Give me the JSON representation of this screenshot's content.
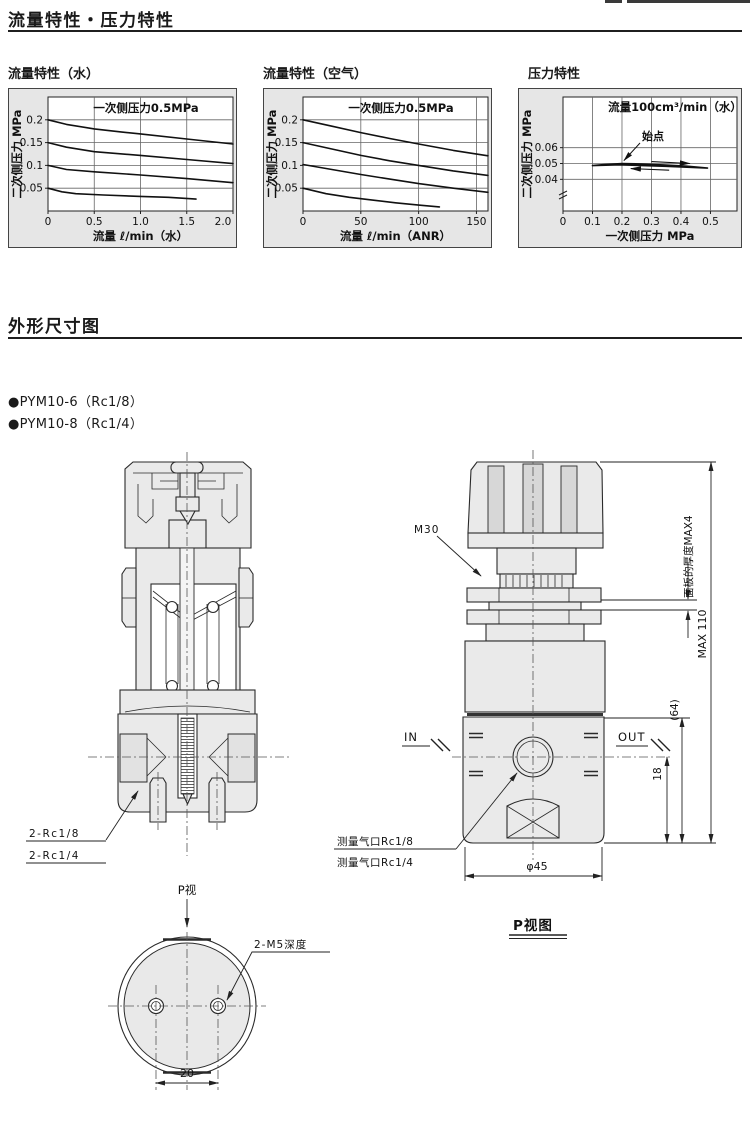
{
  "page": {
    "header1": "流量特性・压力特性",
    "header2": "外形尺寸图",
    "bullets": [
      "●PYM10-6（Rc1/8）",
      "●PYM10-8（Rc1/4）"
    ]
  },
  "colors": {
    "line": "#111111",
    "chart_panel_bg": "#e6e6e6",
    "plot_bg": "#ffffff",
    "drawing_fill": "#eaeaea"
  },
  "chart_data": [
    {
      "type": "line",
      "title": "流量特性（水）",
      "annotation": "一次侧压力0.5MPa",
      "xlabel": "流量 ℓ/min（水）",
      "ylabel": "二次侧压力 MPa",
      "xlim": [
        0,
        2.0
      ],
      "ylim": [
        0,
        0.25
      ],
      "xticks": [
        0,
        0.5,
        1.0,
        1.5,
        2.0
      ],
      "xtick_labels": [
        "0",
        "0.5",
        "1.0",
        "1.5",
        "2.0"
      ],
      "yticks": [
        0.05,
        0.1,
        0.15,
        0.2
      ],
      "ytick_labels": [
        "0.05",
        "0.1",
        "0.15",
        "0.2"
      ],
      "grid": true,
      "legend": "none",
      "series": [
        {
          "name": "0.2MPa",
          "points": [
            [
              0,
              0.2
            ],
            [
              0.2,
              0.19
            ],
            [
              0.5,
              0.18
            ],
            [
              0.8,
              0.173
            ],
            [
              1.0,
              0.169
            ],
            [
              1.5,
              0.158
            ],
            [
              2.0,
              0.147
            ]
          ]
        },
        {
          "name": "0.15MPa",
          "points": [
            [
              0,
              0.15
            ],
            [
              0.2,
              0.14
            ],
            [
              0.5,
              0.13
            ],
            [
              1.0,
              0.122
            ],
            [
              1.5,
              0.113
            ],
            [
              2.0,
              0.104
            ]
          ]
        },
        {
          "name": "0.1MPa",
          "points": [
            [
              0,
              0.1
            ],
            [
              0.2,
              0.091
            ],
            [
              0.5,
              0.086
            ],
            [
              1.0,
              0.079
            ],
            [
              1.5,
              0.071
            ],
            [
              2.0,
              0.062
            ]
          ]
        },
        {
          "name": "0.05MPa",
          "points": [
            [
              0,
              0.05
            ],
            [
              0.15,
              0.042
            ],
            [
              0.3,
              0.038
            ],
            [
              0.6,
              0.035
            ],
            [
              1.0,
              0.032
            ],
            [
              1.3,
              0.03
            ],
            [
              1.6,
              0.026
            ]
          ]
        }
      ]
    },
    {
      "type": "line",
      "title": "流量特性（空气）",
      "annotation": "一次侧压力0.5MPa",
      "xlabel": "流量 ℓ/min（ANR）",
      "ylabel": "二次侧压力 MPa",
      "xlim": [
        0,
        160
      ],
      "ylim": [
        0,
        0.25
      ],
      "xticks": [
        0,
        50,
        100,
        150
      ],
      "xtick_labels": [
        "0",
        "50",
        "100",
        "150"
      ],
      "yticks": [
        0.05,
        0.1,
        0.15,
        0.2
      ],
      "ytick_labels": [
        "0.05",
        "0.1",
        "0.15",
        "0.2"
      ],
      "grid": true,
      "legend": "none",
      "series": [
        {
          "name": "0.2MPa",
          "points": [
            [
              0,
              0.2
            ],
            [
              25,
              0.186
            ],
            [
              50,
              0.172
            ],
            [
              75,
              0.159
            ],
            [
              100,
              0.147
            ],
            [
              130,
              0.133
            ],
            [
              160,
              0.121
            ]
          ]
        },
        {
          "name": "0.15MPa",
          "points": [
            [
              0,
              0.15
            ],
            [
              25,
              0.136
            ],
            [
              50,
              0.122
            ],
            [
              75,
              0.11
            ],
            [
              100,
              0.1
            ],
            [
              130,
              0.088
            ],
            [
              160,
              0.078
            ]
          ]
        },
        {
          "name": "0.1MPa",
          "points": [
            [
              0,
              0.102
            ],
            [
              25,
              0.091
            ],
            [
              50,
              0.08
            ],
            [
              75,
              0.07
            ],
            [
              100,
              0.06
            ],
            [
              130,
              0.05
            ],
            [
              160,
              0.041
            ]
          ]
        },
        {
          "name": "0.05MPa",
          "points": [
            [
              0,
              0.05
            ],
            [
              20,
              0.038
            ],
            [
              40,
              0.03
            ],
            [
              60,
              0.024
            ],
            [
              80,
              0.018
            ],
            [
              100,
              0.013
            ],
            [
              118,
              0.009
            ]
          ]
        }
      ]
    },
    {
      "type": "line",
      "title": "压力特性",
      "annotation": "流量100cm³/min（水）",
      "xlabel": "一次侧压力 MPa",
      "ylabel": "二次侧压力 MPa",
      "xlim": [
        0,
        0.59
      ],
      "ylim": [
        0.02,
        0.092
      ],
      "xticks": [
        0,
        0.1,
        0.2,
        0.3,
        0.4,
        0.5
      ],
      "xtick_labels": [
        "0",
        "0.1",
        "0.2",
        "0.3",
        "0.4",
        "0.5"
      ],
      "yticks": [
        0.04,
        0.05,
        0.06
      ],
      "ytick_labels": [
        "0.04",
        "0.05",
        "0.06"
      ],
      "grid": true,
      "legend": "none",
      "series": [
        {
          "name": "hysteresis-loop",
          "points": [
            [
              0.1,
              0.0487
            ],
            [
              0.14,
              0.0494
            ],
            [
              0.2,
              0.05
            ],
            [
              0.27,
              0.0497
            ],
            [
              0.34,
              0.0491
            ],
            [
              0.42,
              0.0483
            ],
            [
              0.49,
              0.0471
            ],
            [
              0.43,
              0.0476
            ],
            [
              0.35,
              0.0482
            ],
            [
              0.27,
              0.0487
            ],
            [
              0.19,
              0.0492
            ],
            [
              0.1,
              0.0487
            ]
          ]
        }
      ],
      "annotations": {
        "start_label": "始点",
        "start_point": [
          0.2,
          0.05
        ],
        "direction_arrows": [
          {
            "from": [
              0.3,
              0.0512
            ],
            "to": [
              0.43,
              0.05
            ]
          },
          {
            "from": [
              0.36,
              0.0458
            ],
            "to": [
              0.23,
              0.0468
            ]
          }
        ]
      }
    }
  ],
  "labels": {
    "section_view": {
      "port_top": "2-Rc1/8",
      "port_bottom": "2-Rc1/4"
    },
    "side_view": {
      "thread": "M30",
      "panel_thickness": "面板的厚度MAX4",
      "overall_height": "MAX 110",
      "body_height": "(64)",
      "port_height": "18",
      "inlet": "IN",
      "outlet": "OUT",
      "gauge_port_top": "测量气口Rc1/8",
      "gauge_port_bottom": "测量气口Rc1/4",
      "body_diameter": "φ45"
    },
    "p_view": {
      "view_arrow": "P视",
      "mounting_holes": "2-M5深度",
      "hole_pitch": "20",
      "caption": "P视图"
    }
  }
}
